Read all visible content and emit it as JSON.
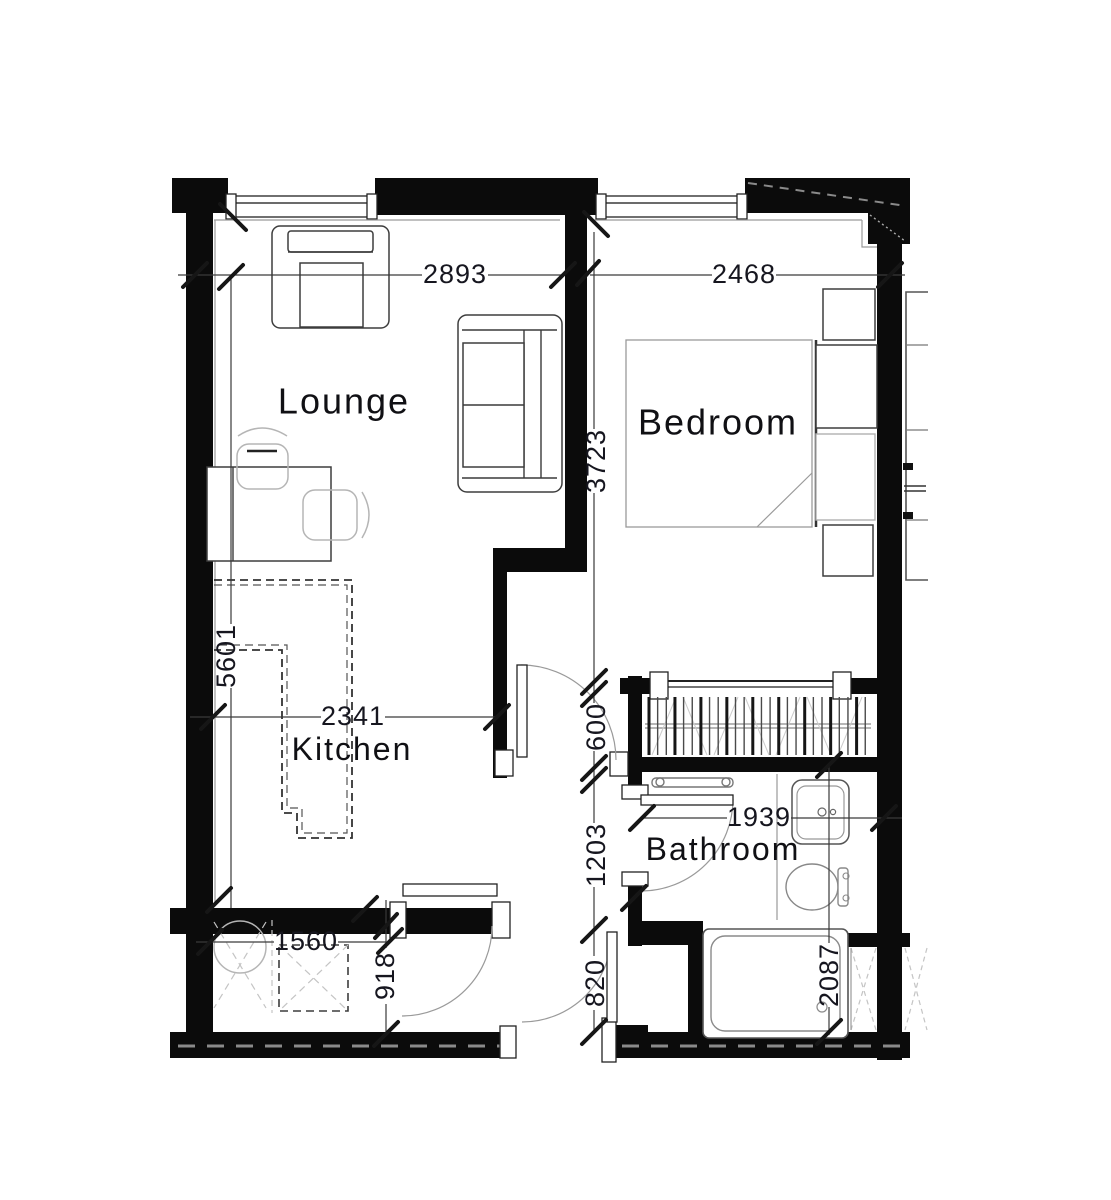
{
  "floorplan": {
    "rooms": [
      {
        "id": "lounge",
        "name": "Lounge"
      },
      {
        "id": "bedroom",
        "name": "Bedroom"
      },
      {
        "id": "kitchen",
        "name": "Kitchen"
      },
      {
        "id": "bathroom",
        "name": "Bathroom"
      }
    ],
    "dimensions_mm": [
      {
        "id": "lounge-width",
        "value": "2893"
      },
      {
        "id": "bedroom-width",
        "value": "2468"
      },
      {
        "id": "bedroom-depth",
        "value": "3723"
      },
      {
        "id": "lounge-kitchen-depth",
        "value": "5601"
      },
      {
        "id": "kitchen-width",
        "value": "2341"
      },
      {
        "id": "wardrobe-depth",
        "value": "600"
      },
      {
        "id": "bathroom-depth",
        "value": "1203"
      },
      {
        "id": "bathroom-width",
        "value": "1939"
      },
      {
        "id": "utility-width",
        "value": "1560"
      },
      {
        "id": "hall-depth",
        "value": "918"
      },
      {
        "id": "entry-door-width",
        "value": "820"
      },
      {
        "id": "bathroom-length",
        "value": "2087"
      }
    ],
    "colors": {
      "wall": "#0b0b0b",
      "dim_text": "#16161f",
      "label_text": "#101014",
      "line": "#3a3a3a",
      "light_line": "#9a9a9a"
    }
  }
}
